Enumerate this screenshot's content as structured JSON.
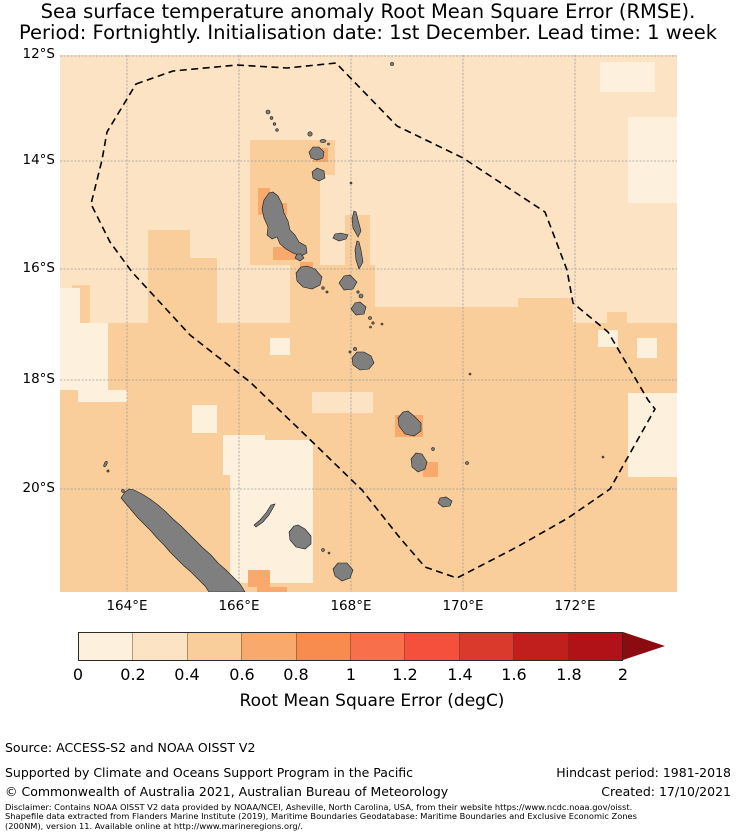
{
  "title": {
    "line1": "Sea surface temperature anomaly Root Mean Square Error (RMSE).",
    "line2": "Period: Fortnightly. Initialisation date: 1st December. Lead time: 1 week"
  },
  "map": {
    "y_ticks": [
      "12°S",
      "14°S",
      "16°S",
      "18°S",
      "20°S"
    ],
    "x_ticks": [
      "164°E",
      "166°E",
      "168°E",
      "170°E",
      "172°E"
    ],
    "overlays": [
      "Vanuatu EEZ dashed boundary",
      "Vanuatu island chain",
      "New Caledonia",
      "Loyalty Islands"
    ]
  },
  "colorbar": {
    "label": "Root Mean Square Error (degC)",
    "ticks": [
      "0",
      "0.2",
      "0.4",
      "0.6",
      "0.8",
      "1",
      "1.2",
      "1.4",
      "1.6",
      "1.8",
      "2"
    ],
    "extend": "max-arrow"
  },
  "palette": {
    "bin1": "#FDF1DD",
    "bin2": "#FCE3C4",
    "bin3": "#FACE9B",
    "bin4": "#F8A96B",
    "bin5": "#F78C4E",
    "bin6": "#F86F4C",
    "bin7": "#F5503B",
    "bin8": "#D93A2B",
    "bin9": "#C11E1E",
    "bin10": "#B01217",
    "arrow": "#8B0B10",
    "land": "#7f7f7f",
    "grid": "#9a9a9a"
  },
  "footer": {
    "source": "Source: ACCESS-S2 and NOAA OISST V2",
    "supported": "Supported by Climate and Oceans Support Program in the Pacific",
    "copyright": "© Commonwealth of Australia 2021, Australian Bureau of Meteorology",
    "hindcast": "Hindcast period: 1981-2018",
    "created": "Created: 17/10/2021",
    "disclaimer_line1": "Disclaimer: Contains NOAA OISST V2 data provided by NOAA/NCEI, Asheville, North Carolina, USA, from their website https://www.ncdc.noaa.gov/oisst.",
    "disclaimer_line2": "Shapefile data extracted from Flanders Marine Institute (2019), Maritime Boundaries Geodatabase: Maritime Boundaries and Exclusive Economic Zones",
    "disclaimer_line3": "(200NM), version 11. Available online at http://www.marineregions.org/."
  },
  "chart_data": {
    "type": "heatmap",
    "title": "Sea surface temperature anomaly Root Mean Square Error (RMSE). Period: Fortnightly. Initialisation date: 1st December. Lead time: 1 week",
    "x_axis": {
      "label": "longitude",
      "tick_labels": [
        "164°E",
        "166°E",
        "168°E",
        "170°E",
        "172°E"
      ],
      "range_deg_east": [
        162.8,
        173.8
      ]
    },
    "y_axis": {
      "label": "latitude",
      "tick_labels": [
        "12°S",
        "14°S",
        "16°S",
        "18°S",
        "20°S"
      ],
      "range_deg_south": [
        12.0,
        21.6
      ]
    },
    "colorbar": {
      "label": "Root Mean Square Error (degC)",
      "tick_values": [
        0,
        0.2,
        0.4,
        0.6,
        0.8,
        1,
        1.2,
        1.4,
        1.6,
        1.8,
        2
      ],
      "bin_width": 0.2,
      "extend_above": 2,
      "colormap": "light cream to dark red (OrRd-like), 10 discrete bins"
    },
    "value_summary": {
      "open_ocean_north_of_16S": "0.2-0.4 degC",
      "southern_half_and_around_islands": "0.4-0.6 degC",
      "scattered_light_patches_west_and_east": "0.0-0.2 degC",
      "small_patches_adjacent_to_islands (Vanua Lava, Santo, Erromango, Tanna, south of New Caledonia)": "0.6-0.8 degC"
    },
    "annotations": [
      "dashed polygon = Vanuatu Exclusive Economic Zone boundary",
      "gray shapes = land (Vanuatu archipelago, New Caledonia, Loyalty Islands)"
    ],
    "grid": true,
    "legend_position": "horizontal colorbar below map"
  }
}
